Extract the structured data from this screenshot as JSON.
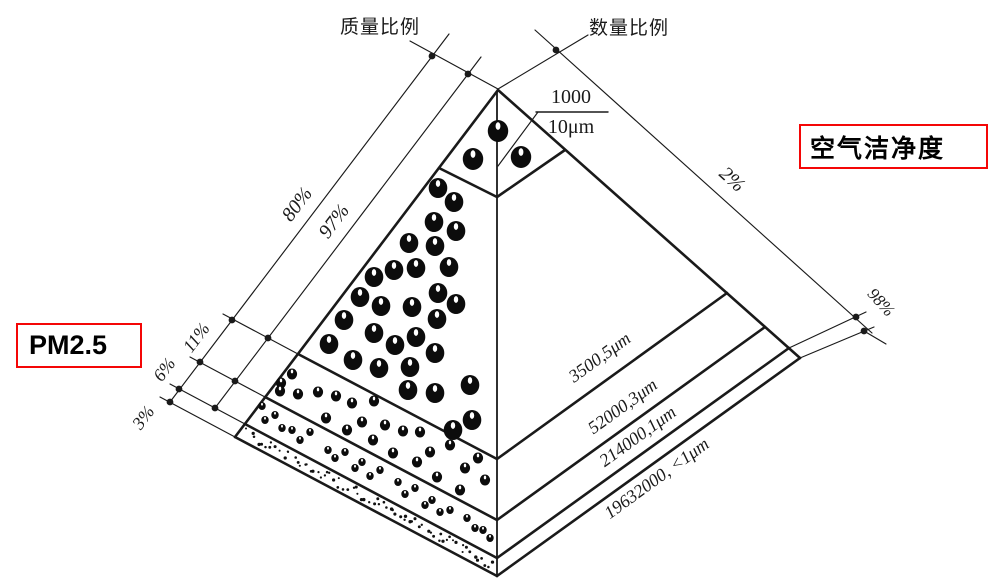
{
  "labels": {
    "mass_ratio": "质量比例",
    "count_ratio": "数量比例",
    "air_cleanliness": "空气洁净度",
    "pm25": "PM2.5",
    "fraction_numerator": "1000",
    "fraction_denominator": "10μm"
  },
  "percent_labels": [
    {
      "id": "mass-percent-80",
      "text": "80%",
      "x": 302,
      "y": 208,
      "rot": -53,
      "size": 20
    },
    {
      "id": "mass-percent-97",
      "text": "97%",
      "x": 339,
      "y": 225,
      "rot": -53,
      "size": 20
    },
    {
      "id": "mass-percent-11",
      "text": "11%",
      "x": 201,
      "y": 341,
      "rot": -53,
      "size": 18
    },
    {
      "id": "mass-percent-6",
      "text": "6%",
      "x": 169,
      "y": 373,
      "rot": -53,
      "size": 18
    },
    {
      "id": "mass-percent-3",
      "text": "3%",
      "x": 148,
      "y": 421,
      "rot": -53,
      "size": 18
    },
    {
      "id": "count-percent-2",
      "text": "2%",
      "x": 728,
      "y": 184,
      "rot": 42,
      "size": 20
    },
    {
      "id": "count-percent-98",
      "text": "98%",
      "x": 877,
      "y": 306,
      "rot": 48,
      "size": 17
    }
  ],
  "band_labels": [
    {
      "id": "band-label-5um",
      "text": "3500,5μm",
      "x": 603,
      "y": 362,
      "rot": -36
    },
    {
      "id": "band-label-3um",
      "text": "52000,3μm",
      "x": 626,
      "y": 411,
      "rot": -36
    },
    {
      "id": "band-label-1um",
      "text": "214000,1μm",
      "x": 641,
      "y": 441,
      "rot": -36
    },
    {
      "id": "band-label-sub1um",
      "text": "19632000, <1μm",
      "x": 660,
      "y": 483,
      "rot": -36
    }
  ],
  "pyramid_slices": [
    {
      "count": "1000",
      "particle_size": "10μm"
    },
    {
      "count": "3500",
      "particle_size": "5μm"
    },
    {
      "count": "52000",
      "particle_size": "3μm"
    },
    {
      "count": "214000",
      "particle_size": "1μm"
    },
    {
      "count": "19632000",
      "particle_size": "<1μm"
    }
  ],
  "mass_ratio_percents": [
    "80%",
    "11%",
    "6%",
    "3%"
  ],
  "mass_ratio_cumulative": "97%",
  "count_ratio_percents": [
    "2%",
    "98%"
  ],
  "colors": {
    "line": "#1a1a1a",
    "box_border": "#f40606",
    "background": "#ffffff"
  },
  "particles": {
    "top_radius": 11,
    "top": [
      [
        498,
        131
      ],
      [
        473,
        159
      ],
      [
        521,
        157
      ]
    ],
    "large_radius": 10,
    "large": [
      [
        438,
        188
      ],
      [
        454,
        202
      ],
      [
        434,
        222
      ],
      [
        456,
        231
      ],
      [
        409,
        243
      ],
      [
        435,
        246
      ],
      [
        449,
        267
      ],
      [
        416,
        268
      ],
      [
        394,
        270
      ],
      [
        374,
        277
      ],
      [
        360,
        297
      ],
      [
        381,
        306
      ],
      [
        412,
        307
      ],
      [
        438,
        293
      ],
      [
        456,
        304
      ],
      [
        344,
        320
      ],
      [
        374,
        333
      ],
      [
        395,
        345
      ],
      [
        416,
        337
      ],
      [
        437,
        319
      ],
      [
        329,
        344
      ],
      [
        353,
        360
      ],
      [
        379,
        368
      ],
      [
        410,
        367
      ],
      [
        435,
        353
      ],
      [
        408,
        390
      ],
      [
        435,
        393
      ],
      [
        470,
        385
      ],
      [
        453,
        430
      ],
      [
        472,
        420
      ]
    ],
    "medium_radius": 5.5,
    "medium": [
      [
        281,
        383
      ],
      [
        280,
        391
      ],
      [
        292,
        374
      ],
      [
        298,
        394
      ],
      [
        318,
        392
      ],
      [
        336,
        396
      ],
      [
        352,
        403
      ],
      [
        374,
        401
      ],
      [
        326,
        418
      ],
      [
        347,
        430
      ],
      [
        362,
        422
      ],
      [
        373,
        440
      ],
      [
        385,
        425
      ],
      [
        403,
        431
      ],
      [
        420,
        432
      ],
      [
        393,
        453
      ],
      [
        430,
        452
      ],
      [
        417,
        462
      ],
      [
        437,
        477
      ],
      [
        450,
        445
      ],
      [
        465,
        468
      ],
      [
        460,
        490
      ],
      [
        478,
        458
      ],
      [
        485,
        480
      ]
    ],
    "small_radius": 4,
    "small": [
      [
        262,
        406
      ],
      [
        265,
        420
      ],
      [
        275,
        415
      ],
      [
        292,
        430
      ],
      [
        310,
        432
      ],
      [
        328,
        450
      ],
      [
        345,
        452
      ],
      [
        362,
        462
      ],
      [
        380,
        470
      ],
      [
        398,
        482
      ],
      [
        415,
        488
      ],
      [
        432,
        500
      ],
      [
        450,
        510
      ],
      [
        467,
        518
      ],
      [
        483,
        530
      ],
      [
        300,
        440
      ],
      [
        335,
        458
      ],
      [
        370,
        476
      ],
      [
        405,
        494
      ],
      [
        440,
        512
      ],
      [
        475,
        528
      ],
      [
        355,
        468
      ],
      [
        425,
        505
      ],
      [
        490,
        538
      ],
      [
        282,
        428
      ]
    ],
    "speckle_count": 72
  }
}
